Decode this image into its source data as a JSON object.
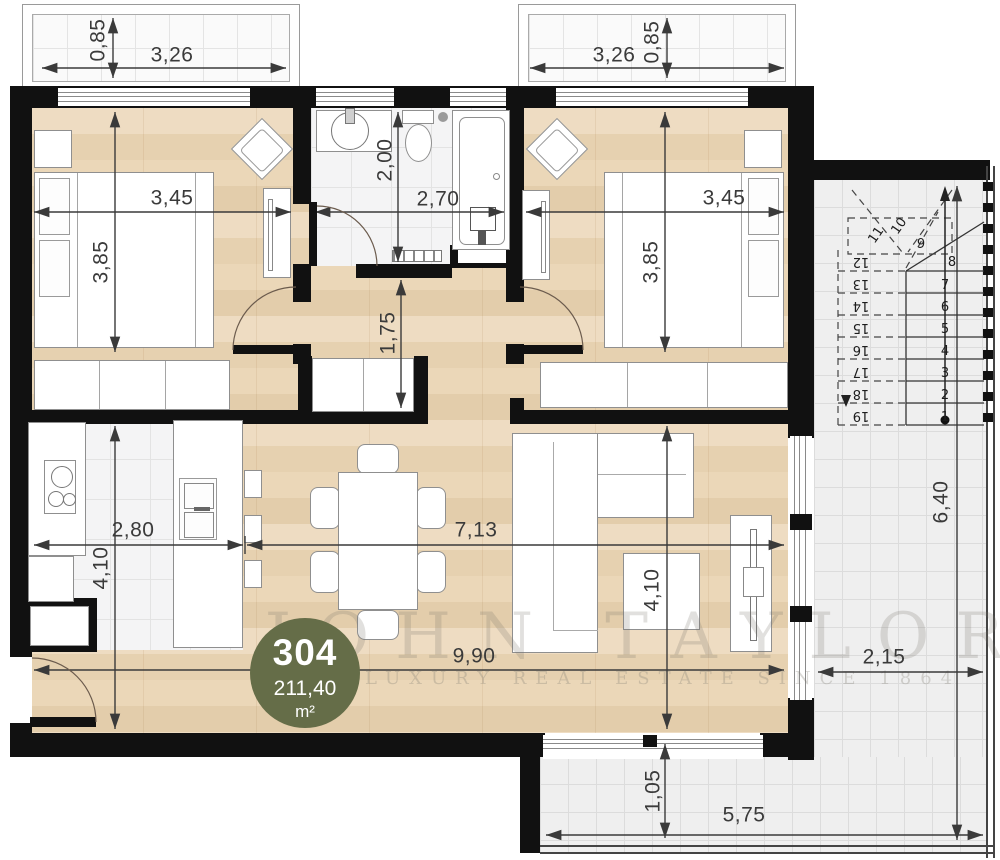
{
  "badge": {
    "unit_number": "304",
    "area_value": "211,40",
    "area_unit": "m²"
  },
  "watermark": {
    "brand": "JOHN TAYLOR",
    "tagline": "LUXURY REAL ESTATE SINCE 1864"
  },
  "dimensions": {
    "balcony_left_depth": "0,85",
    "balcony_left_width": "3,26",
    "balcony_right_width": "3,26",
    "balcony_right_depth": "0,85",
    "bedroom_left_width": "3,45",
    "bedroom_left_height": "3,85",
    "bathroom_height": "2,00",
    "bathroom_width": "2,70",
    "bedroom_right_width": "3,45",
    "bedroom_right_height": "3,85",
    "hallway_height": "1,75",
    "kitchen_width": "2,80",
    "kitchen_height": "4,10",
    "living_width": "7,13",
    "living_height": "4,10",
    "total_width": "9,90",
    "terrace_right_height": "6,40",
    "terrace_right_width": "2,15",
    "terrace_bottom_height": "1,05",
    "terrace_bottom_width": "5,75"
  },
  "stairs": {
    "steps": [
      "1",
      "2",
      "3",
      "4",
      "5",
      "6",
      "7",
      "8",
      "9",
      "10",
      "11",
      "12",
      "13",
      "14",
      "15",
      "16",
      "17",
      "18",
      "19"
    ]
  },
  "colors": {
    "wall": "#111111",
    "badge": "#656d48",
    "dim": "#3a3a3a"
  }
}
